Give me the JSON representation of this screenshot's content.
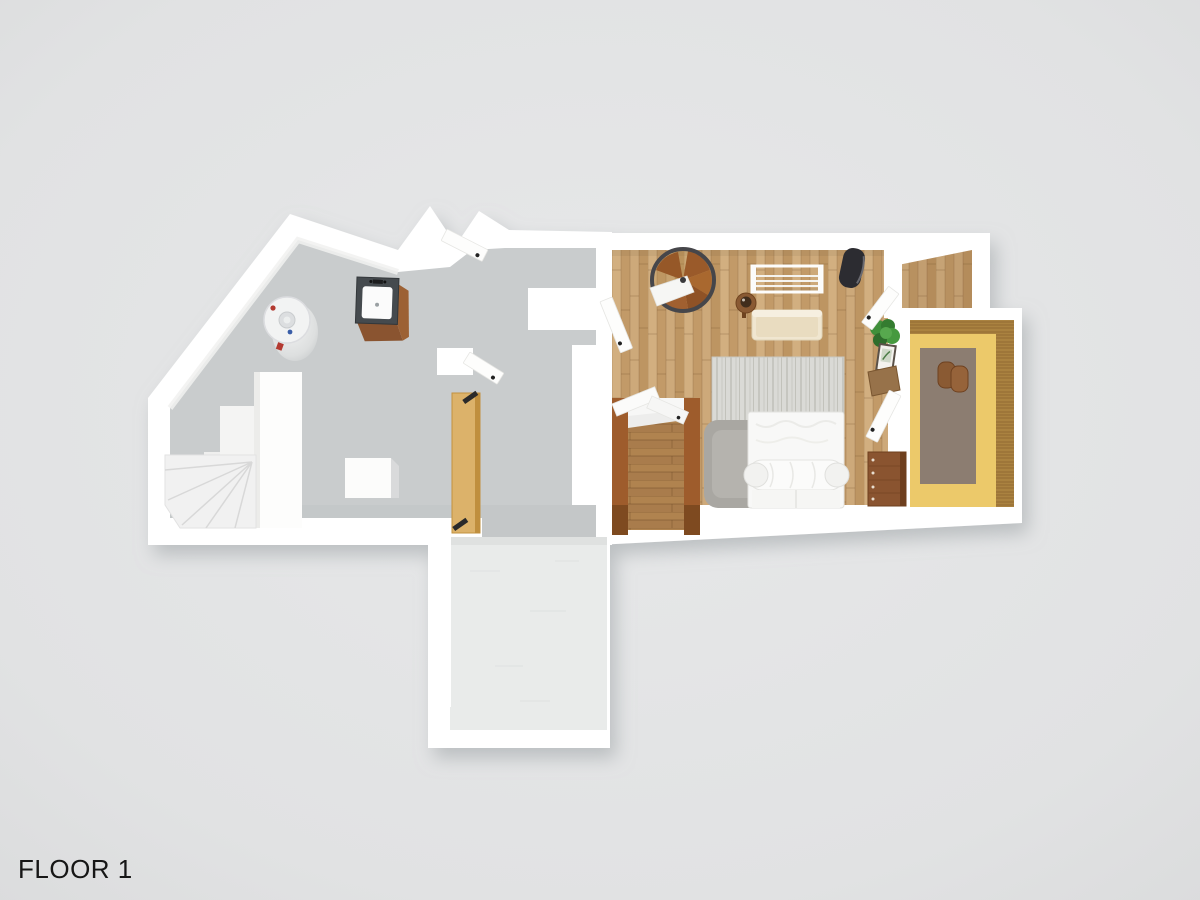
{
  "floor_label": {
    "text": "FLOOR 1"
  },
  "colors": {
    "background": "#e2e3e4",
    "wall": "#ffffff",
    "floor_concrete": "#c9cccd",
    "hall_concrete": "#c4c7c8",
    "wood_light": "#c9a474",
    "wood_stair": "#a97c4c",
    "stair_rail": "#9e5c2c",
    "floor_office": "#ecc96a",
    "office_rug": "#8c7d71",
    "wood_panel": "#aa8240",
    "patio": "#e9ebea",
    "door_tan": "#dcb26a",
    "furniture_brown": "#8a5430",
    "sofa_cream": "#f0e6d0",
    "bed_white": "#f8f8f7",
    "rug_light": "#d9d9d5",
    "rug_fluffy": "#a9a7a2",
    "chair_black": "#2c2c31",
    "plant_green": "#3f8f3a",
    "metal_dark": "#46464a",
    "label_text": "#161616"
  },
  "rooms": [
    {
      "name": "utility-room",
      "floor_material": "gray-concrete"
    },
    {
      "name": "hallway",
      "floor_material": "gray-concrete"
    },
    {
      "name": "bedroom-living-room",
      "floor_material": "light-wood-parquet"
    },
    {
      "name": "stairwell",
      "floor_material": "brown-wood"
    },
    {
      "name": "corridor",
      "floor_material": "light-wood-parquet"
    },
    {
      "name": "den",
      "floor_material": "yellow-floor-with-wood-paneling"
    },
    {
      "name": "patio",
      "floor_material": "white-concrete"
    }
  ],
  "objects": [
    "water-heater",
    "sink-vanity",
    "storage-blocks",
    "storage-box",
    "winder-stairs",
    "leaning-door-panel",
    "spiral-staircase",
    "clothes-rack",
    "black-lounge-chair",
    "side-table-with-bowl",
    "cream-sofa",
    "striped-area-rug",
    "fluffy-gray-rug",
    "double-bed-with-duvet",
    "potted-plant",
    "picture-frame",
    "wall-desk",
    "brown-dresser",
    "stair-side-rails",
    "floor-cushions",
    "open-door-leaves"
  ]
}
